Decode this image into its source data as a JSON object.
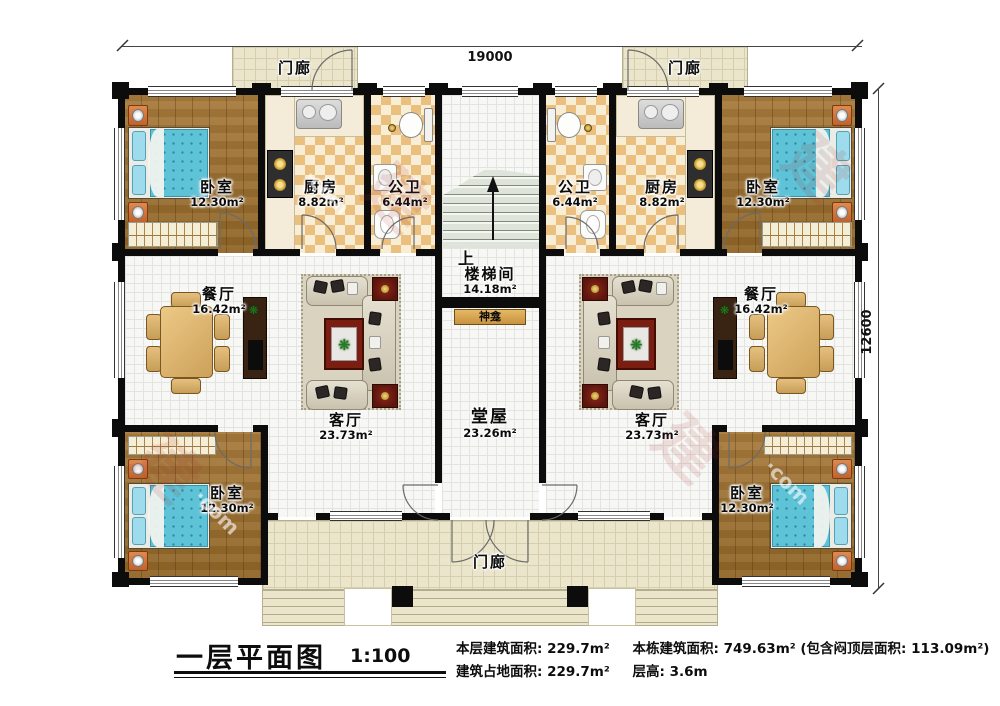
{
  "plan": {
    "dim_top": "19000",
    "dim_right": "12600",
    "porch": "门廊",
    "stair_up": "上",
    "shrine": "神龛",
    "rooms": {
      "bedroom": {
        "name": "卧室",
        "area": "12.30m²"
      },
      "kitchen": {
        "name": "厨房",
        "area": "8.82m²"
      },
      "bath": {
        "name": "公卫",
        "area": "6.44m²"
      },
      "stairwell": {
        "name": "楼梯间",
        "area": "14.18m²"
      },
      "dining": {
        "name": "餐厅",
        "area": "16.42m²"
      },
      "living": {
        "name": "客厅",
        "area": "23.73m²"
      },
      "hall": {
        "name": "堂屋",
        "area": "23.26m²"
      }
    }
  },
  "legend": {
    "title": "一层平面图",
    "scale": "1:100",
    "stats": [
      {
        "label": "本层建筑面积:",
        "value": "229.7m²"
      },
      {
        "label": "本栋建筑面积:",
        "value": "749.63m² (包含闷顶层面积: 113.09m²)"
      },
      {
        "label": "建筑占地面积:",
        "value": "229.7m²"
      },
      {
        "label": "层高:",
        "value": "3.6m"
      }
    ]
  },
  "icons": {
    "plant": "❋"
  },
  "watermark": {
    "cn": "建",
    "en": "·com"
  },
  "colors": {
    "wall": "#0c0c0c",
    "wood": "#9d7134",
    "checker": "#ebbf7d",
    "porch": "#eae5cb",
    "bed": "#5fc3d8",
    "accent_red": "#7a1e12",
    "table_wood": "#cda159"
  }
}
